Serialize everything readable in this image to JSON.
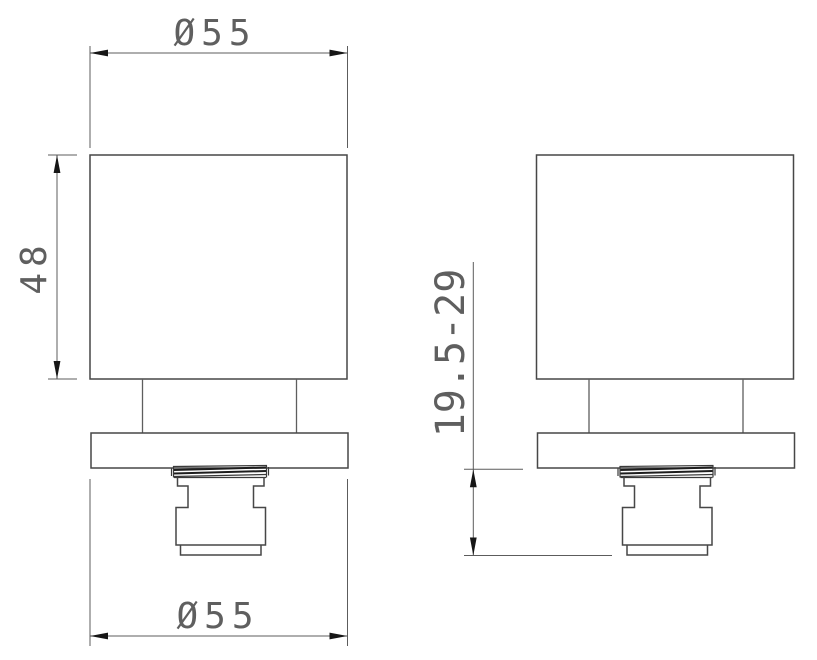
{
  "diagram": {
    "type": "technical-drawing",
    "subject": "square knob with base plate and threaded cartridge, two orthographic views",
    "background_color": "#ffffff",
    "colors": {
      "outline": "#474747",
      "dimension_line": "#5c5c5c",
      "arrow": "#161616",
      "text": "#5f5f5f",
      "thread": "#1d1d1d"
    },
    "views": {
      "front": {
        "name": "front view (left)"
      },
      "side": {
        "name": "side view (right)"
      }
    },
    "dimensions": {
      "top_diameter": {
        "label": "Ø55",
        "location": "above front view, knob body width"
      },
      "height": {
        "label": "48",
        "location": "left of front view, knob body height"
      },
      "bottom_diameter": {
        "label": "Ø55",
        "location": "below front view, base plate width"
      },
      "depth_range": {
        "label": "19.5-29",
        "location": "left of side view, plate underside to cartridge end"
      }
    }
  }
}
